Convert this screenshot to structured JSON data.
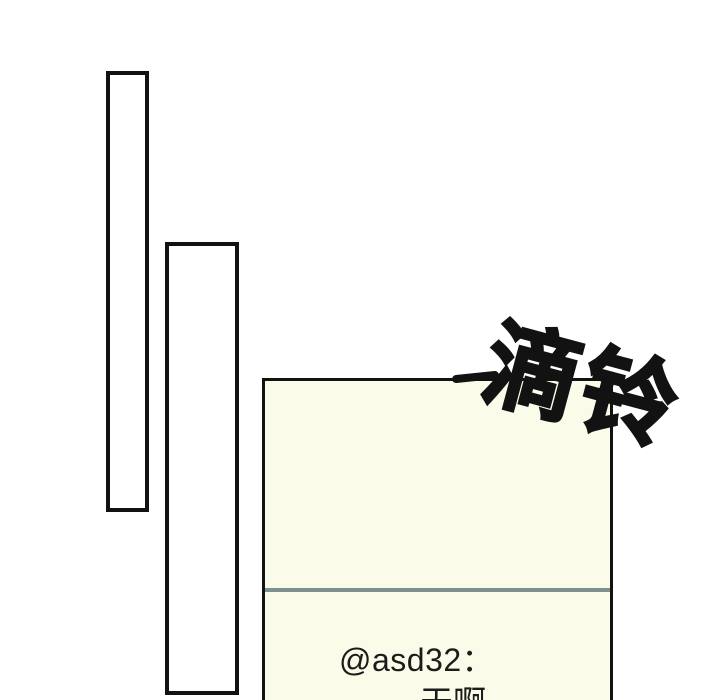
{
  "page": {
    "background_color": "#ffffff",
    "panel_border_color": "#121212"
  },
  "sfx": {
    "text": "滴铃",
    "meaning": "ding-a-ling ringtone sound effect",
    "color": "#121212"
  },
  "comment_panel": {
    "fill_color": "#fafbe8",
    "border_color": "#121212",
    "divider_color": "#7e8f8f",
    "username": "@asd32：",
    "message": "天啊"
  }
}
